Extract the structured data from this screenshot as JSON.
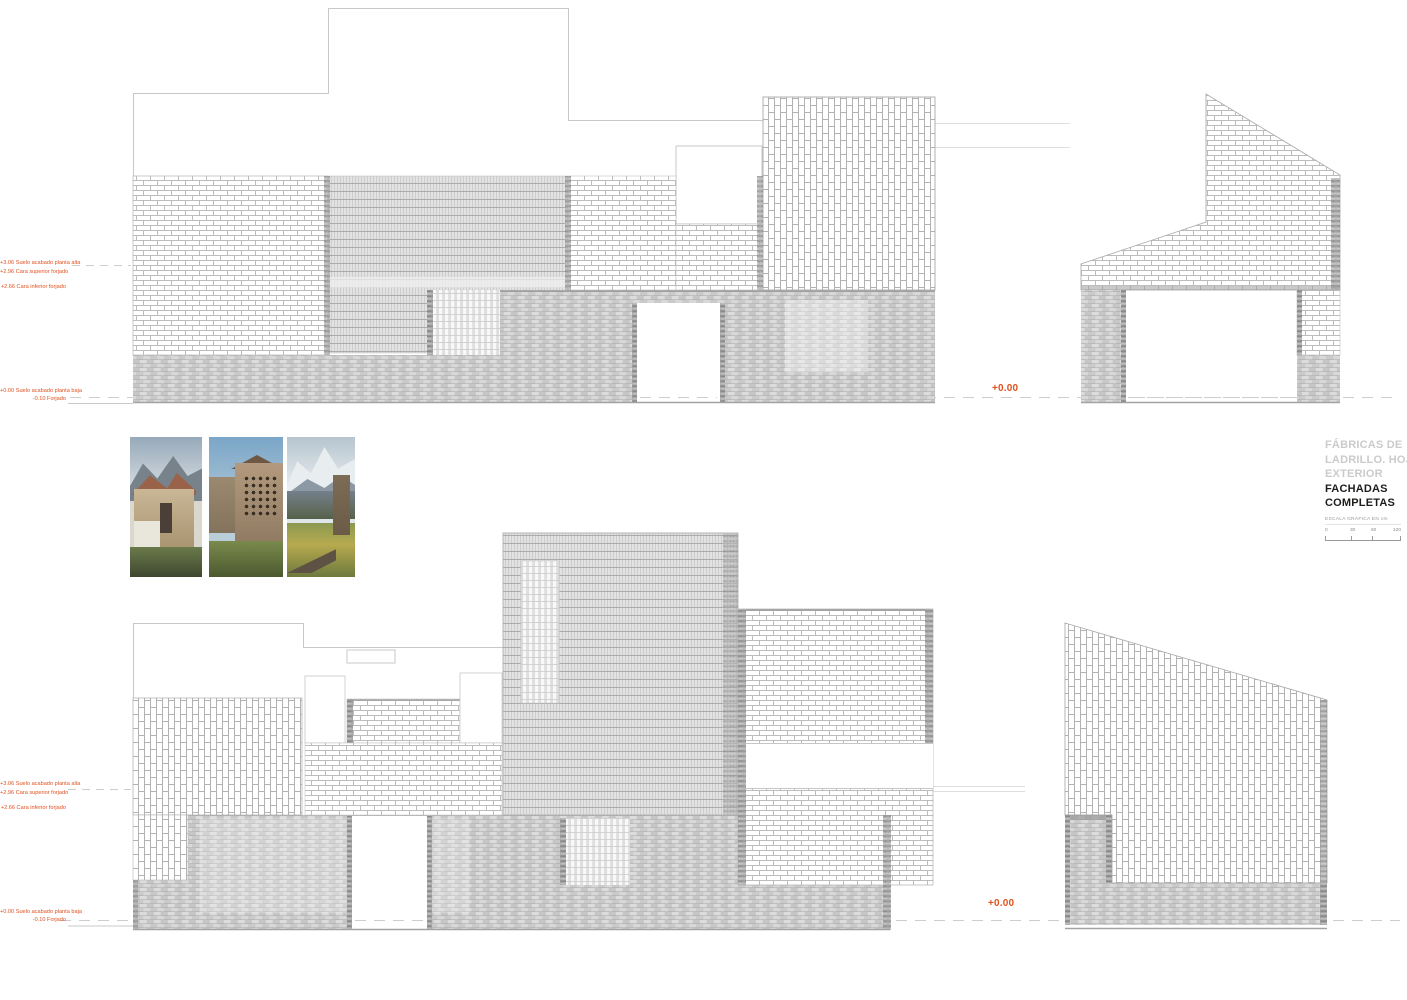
{
  "sheet": {
    "background": "#ffffff",
    "accent_color": "#E0511F",
    "drawing_line_color": "#b5b5b5",
    "plinth_gray": "#cfcfcf",
    "quoin_gray": "#9a9a9a"
  },
  "annotations": {
    "upper_levels": [
      "+3.06 Suelo acabado planta alta",
      "+2.96 Cara superior forjado",
      "+2.66 Cara inferior forjado"
    ],
    "ground_levels": [
      "+0.00 Suelo acabado planta baja",
      "-0.10 Forjado"
    ],
    "datum_marker": "+0.00"
  },
  "title_block": {
    "series_lines": [
      "FÁBRICAS DE",
      "LADRILLO. HOJA",
      "EXTERIOR"
    ],
    "sheet_lines": [
      "FACHADAS",
      "COMPLETAS"
    ],
    "scale_label": "ESCALA GRÁFICA EN cm",
    "scale_ticks": [
      "0",
      "30",
      "60",
      "120"
    ]
  },
  "photos": [
    {
      "id": "photo-1",
      "description": "Rural brick house with tiled roofs and mountain backdrop"
    },
    {
      "id": "photo-2",
      "description": "Brick dovecote with perforated lattice wall in a field"
    },
    {
      "id": "photo-3",
      "description": "Green fields with snowy mountains and brick tower"
    }
  ],
  "drawings": [
    {
      "id": "top-left-elevation"
    },
    {
      "id": "top-right-elevation"
    },
    {
      "id": "bottom-left-elevation"
    },
    {
      "id": "bottom-right-elevation"
    }
  ]
}
